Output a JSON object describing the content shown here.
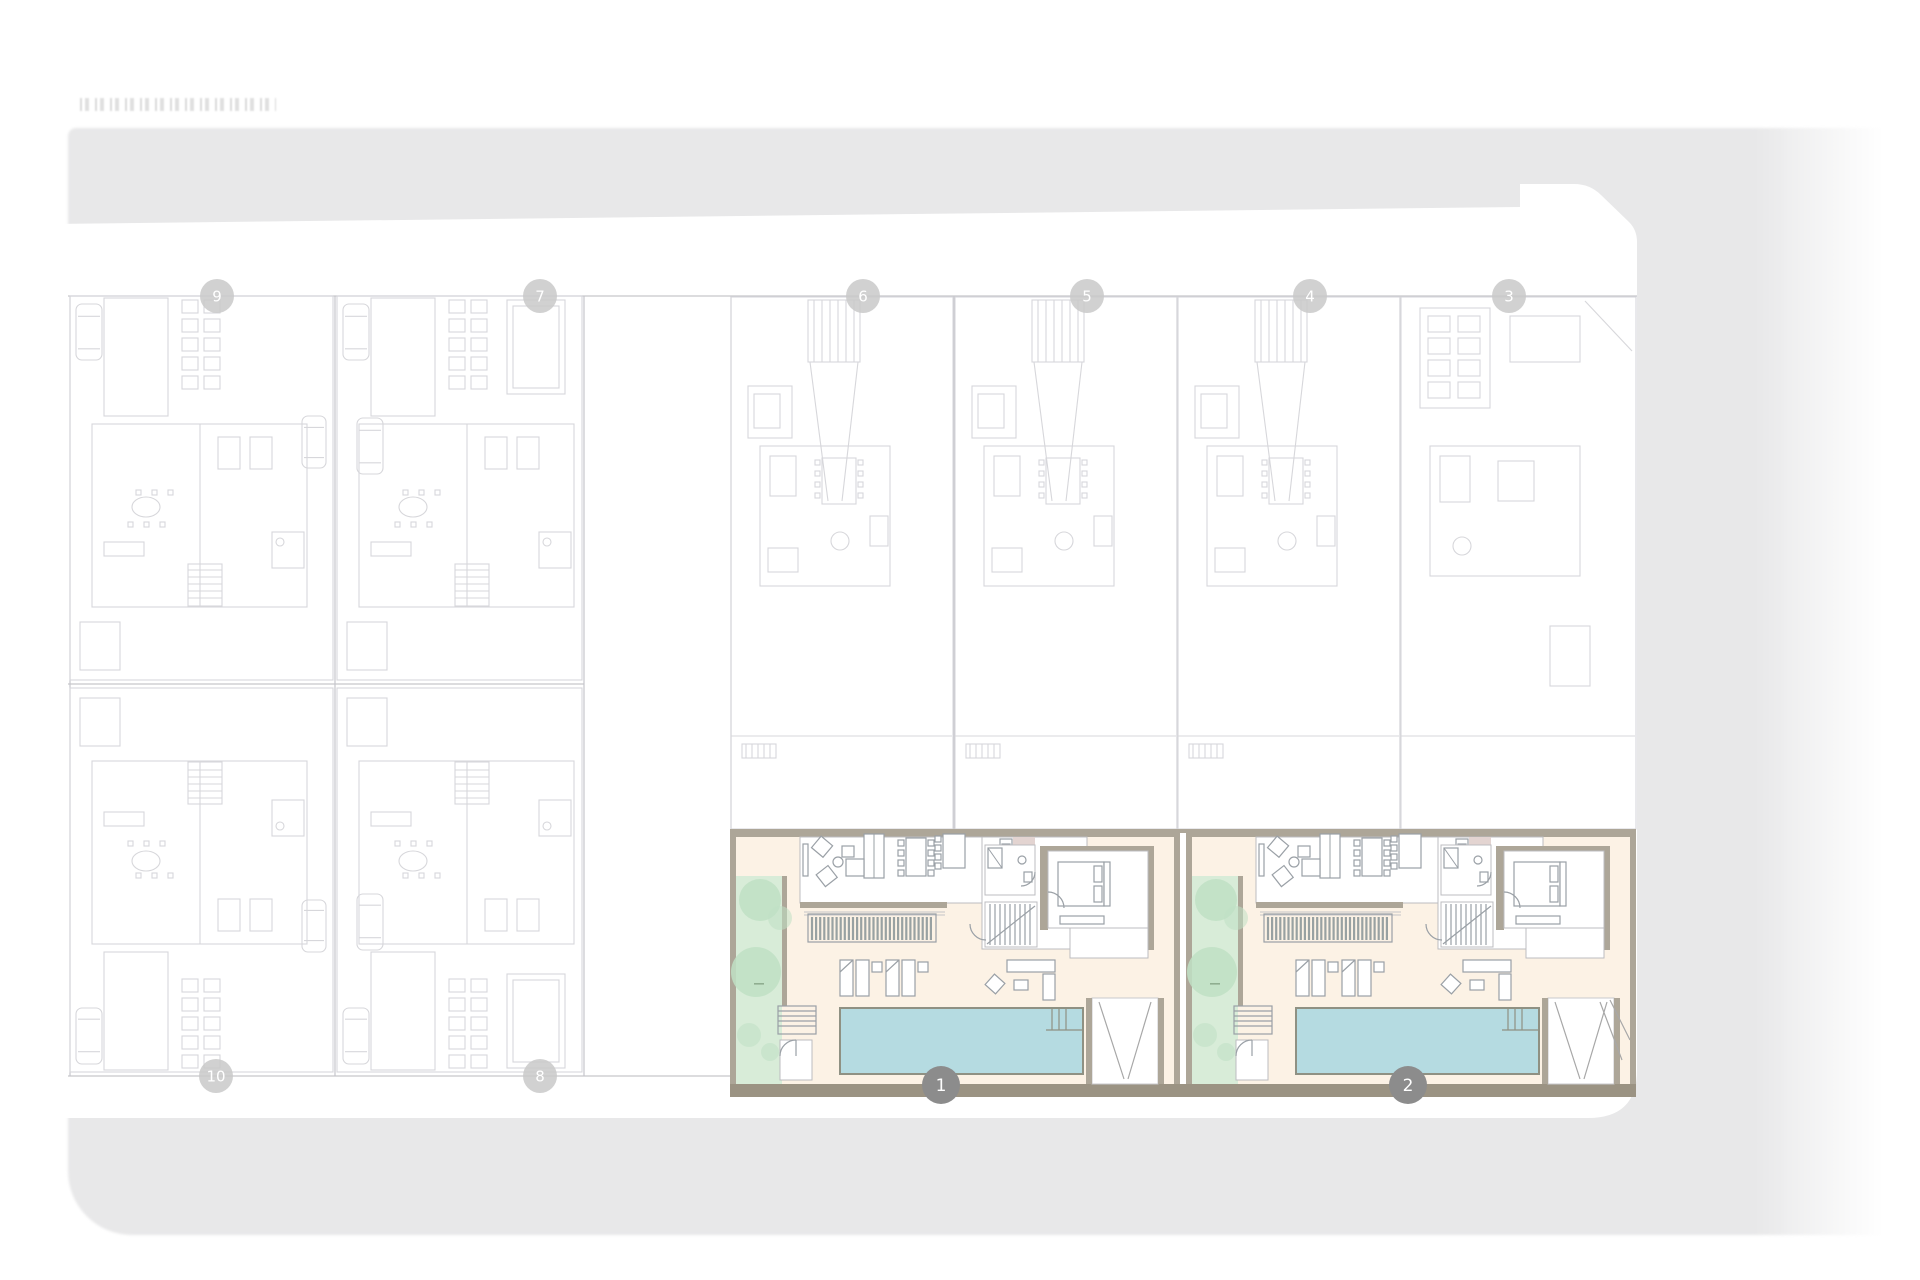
{
  "meta": {
    "highlighted_unit_labels": [
      "1",
      "2"
    ]
  },
  "colors": {
    "page_bg": "#ffffff",
    "street": "#e8e8e9",
    "plot": "#ffffff",
    "line_faint": "#d7d7db",
    "line_mid": "#c6c6cb",
    "furniture": "#9aa0a6",
    "wall": "#ada698",
    "wall_dark": "#9b9383",
    "cream": "#fcf2e5",
    "garden": "#d8ecd8",
    "tree": "#c0e0c4",
    "pool": "#b5dbe1",
    "pool_edge": "#8f9183",
    "deck": "#98a1a2",
    "accent_pink": "#e3d4d1",
    "marker_faded": "#c9c9c9",
    "marker_active": "#8c8c8c",
    "marker_text": "#ffffff"
  },
  "markers": {
    "top": [
      {
        "label": "9",
        "x": 217,
        "y": 296,
        "active": false
      },
      {
        "label": "7",
        "x": 540,
        "y": 296,
        "active": false
      },
      {
        "label": "6",
        "x": 863,
        "y": 296,
        "active": false
      },
      {
        "label": "5",
        "x": 1087,
        "y": 296,
        "active": false
      },
      {
        "label": "4",
        "x": 1310,
        "y": 296,
        "active": false
      },
      {
        "label": "3",
        "x": 1509,
        "y": 296,
        "active": false
      }
    ],
    "bottom": [
      {
        "label": "10",
        "x": 216,
        "y": 1076,
        "active": false
      },
      {
        "label": "8",
        "x": 540,
        "y": 1076,
        "active": false
      },
      {
        "label": "1",
        "x": 941,
        "y": 1085,
        "active": true
      },
      {
        "label": "2",
        "x": 1408,
        "y": 1085,
        "active": true
      }
    ]
  }
}
